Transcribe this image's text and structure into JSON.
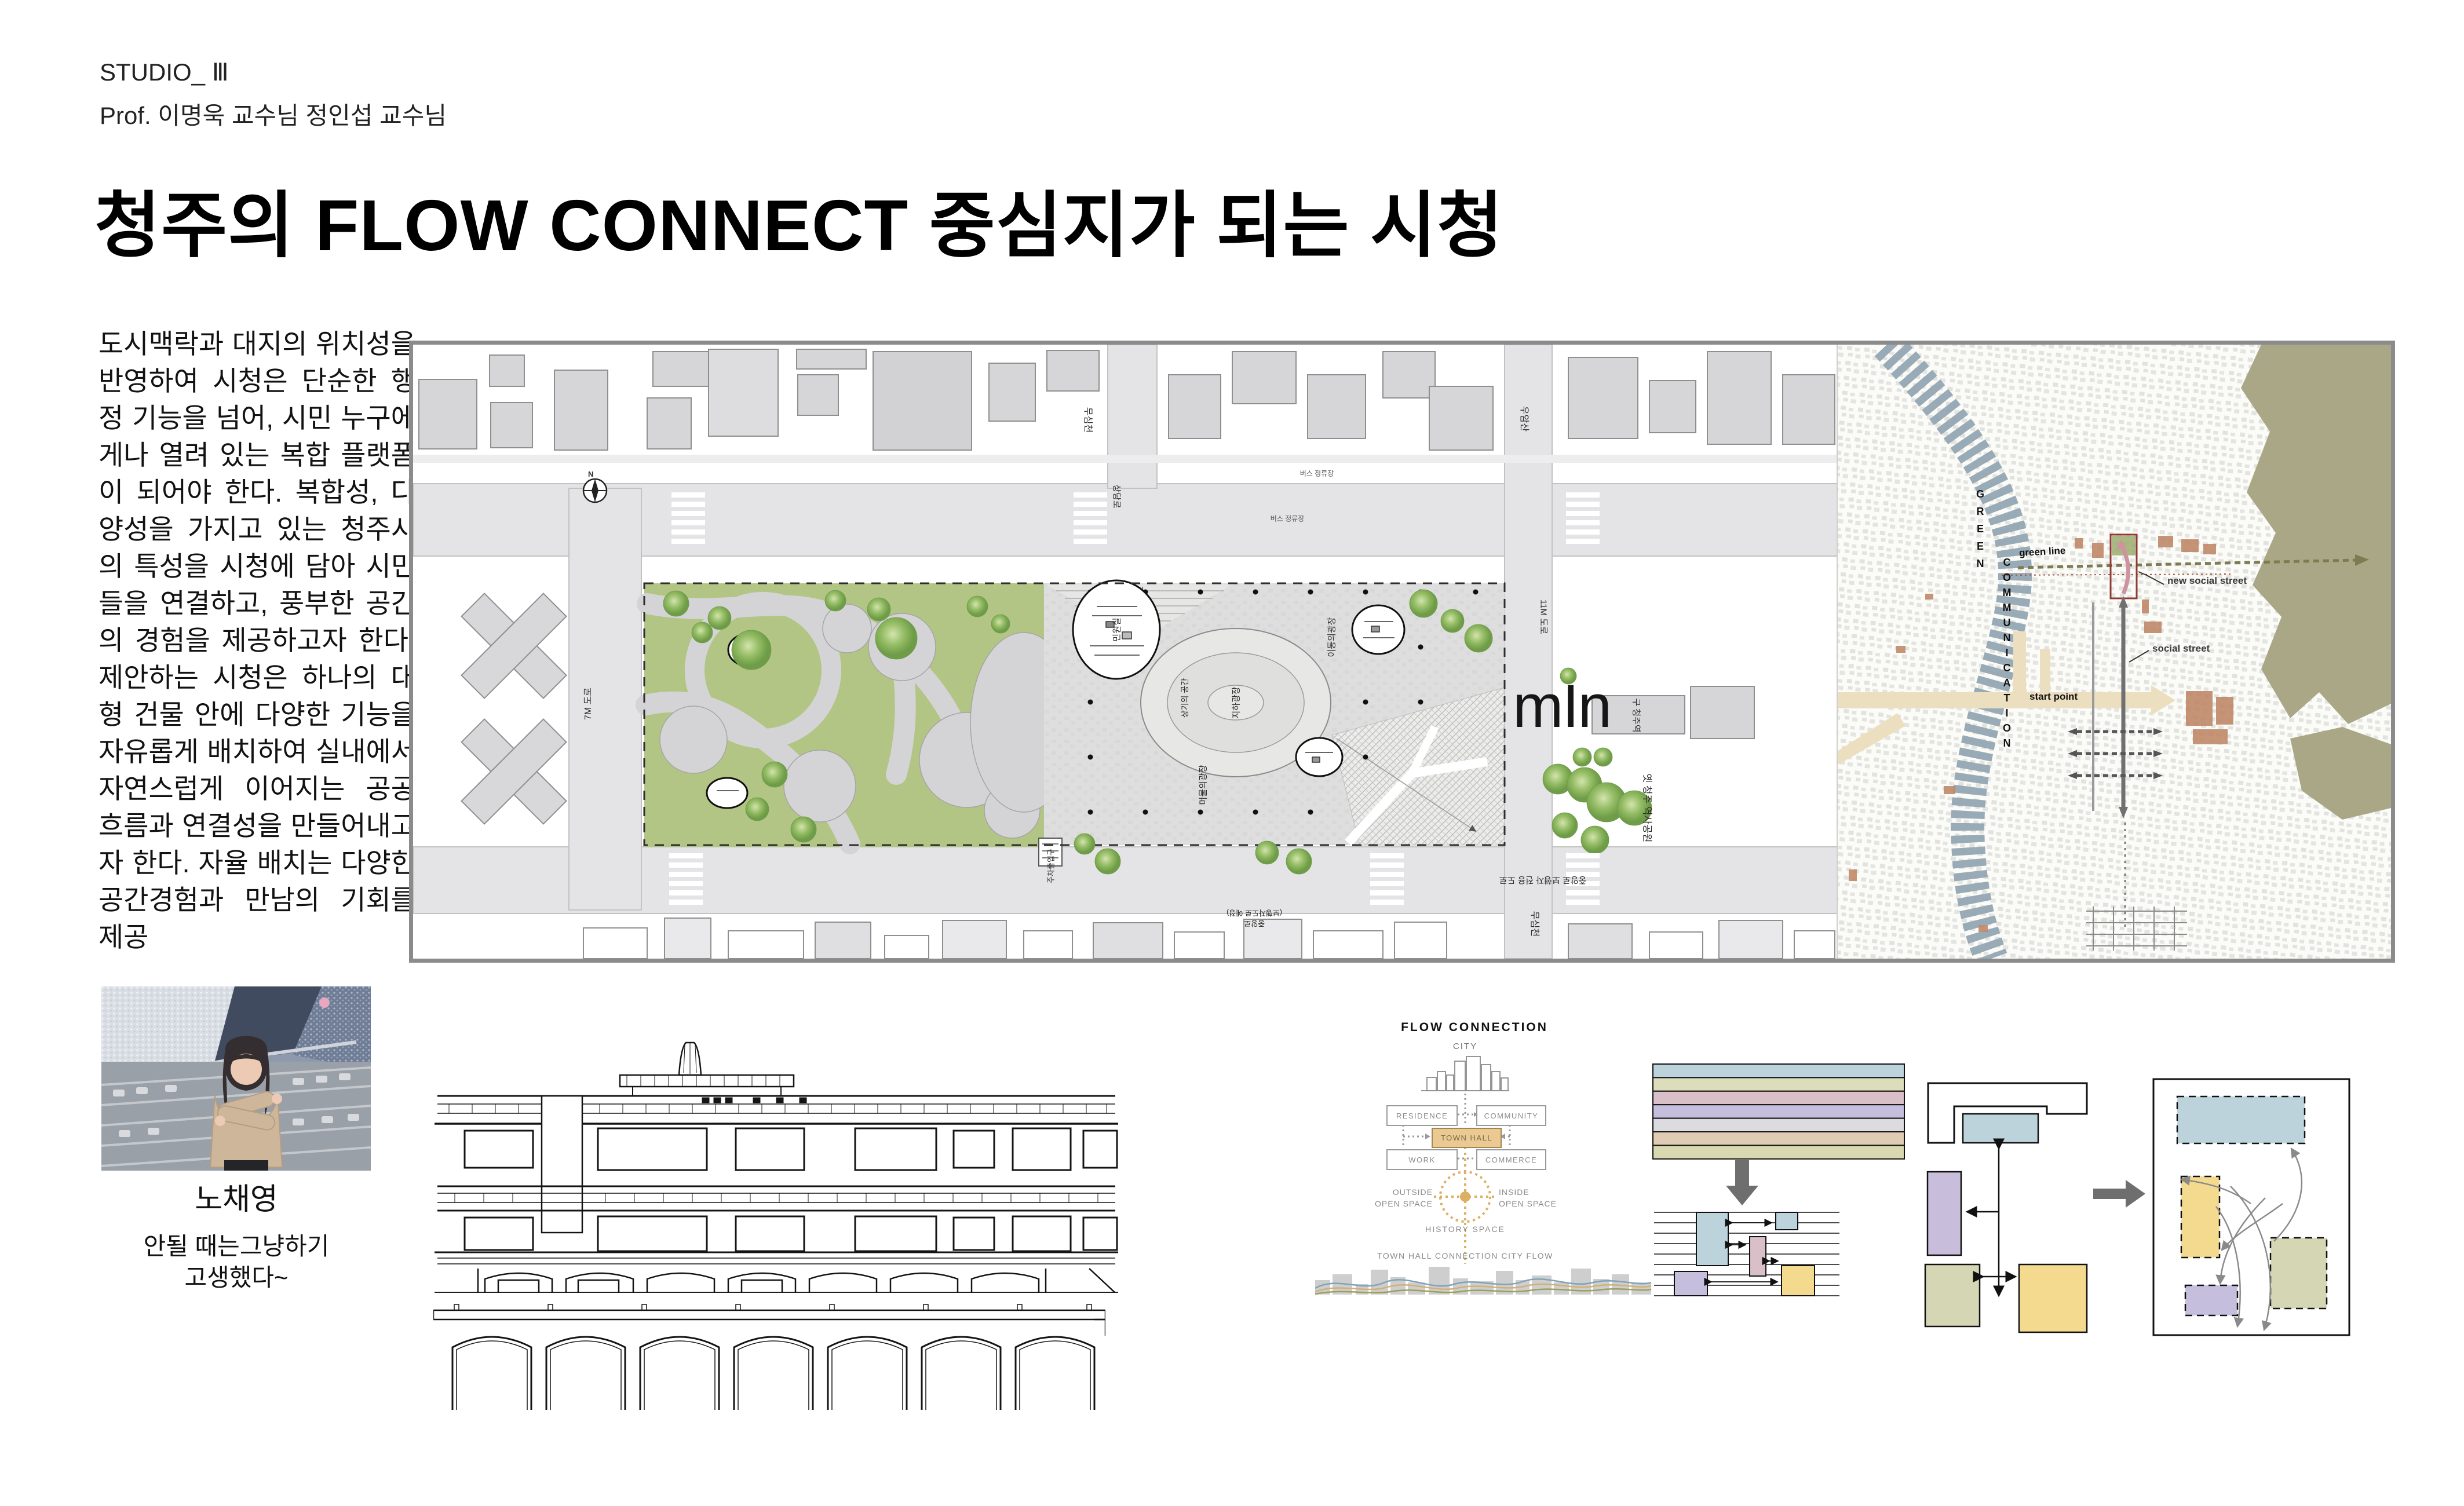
{
  "header": {
    "studio": "STUDIO_ Ⅲ",
    "professors": "Prof. 이명욱 교수님 정인섭 교수님"
  },
  "title": "청주의 FLOW CONNECT 중심지가 되는 시청",
  "intro": "도시맥락과  대지의 위치성을 반영하여 시청은 단순한 행정 기능을 넘어, 시민 누구에게나 열려  있는 복합 플랫폼이 되어야 한다. 복합성, 다양성을 가지고 있는 청주시의 특성을 시청에 담아 시민들을 연결하고, 풍부한 공간의 경험을 제공하고자 한다. 제안하는 시청은 하나의 대형 건물 안에 다양한 기능을 자유롭게 배치하여 실내에서 자연스럽게 이어지는 공공 흐름과 연결성을 만들어내고자 한다. 자율 배치는 다양한 공간경험과 만남의 기회를 제공",
  "member": {
    "name": "노채영",
    "quote_line1": "안될 때는그냥하기",
    "quote_line2": "고생했다~"
  },
  "site_plan": {
    "north": "N",
    "watermark": "mIn",
    "labels": {
      "road_7m": "7M 도로",
      "stream_top": "무심천",
      "sangdang_ro": "상당로",
      "bus_stop_1": "버스 정류장",
      "bus_stop_2": "버스 정류장",
      "wooamsan": "우암산",
      "road_11m": "11M 도로",
      "stream_right": "무심천",
      "old_cheongju_station": "구 청주역",
      "history_park": "옛 청주 역사공원",
      "jungang_ped_road": "중앙로 보행자 전용 도로",
      "jungang_planned": "중앙로\n(보행자도로 예정)",
      "parking_entrance": "주차출입구",
      "sanggi_space": "상기의 공간",
      "minwon_room": "민원실",
      "moving_plaza": "이동의광장",
      "underground_plaza": "지하광장",
      "staying_plaza": "머물의광장"
    }
  },
  "city_map": {
    "labels": {
      "green_word": "GREEN",
      "communication_word": "COMMUNICATION",
      "green_line": "green line",
      "new_social_street": "new social street",
      "social_street": "social street",
      "start_point": "start point"
    }
  },
  "flow_diagram": {
    "title": "FLOW CONNECTION",
    "city": "CITY",
    "residence": "RESIDENCE",
    "community": "COMMUNITY",
    "town_hall": "TOWN HALL",
    "work": "WORK",
    "commerce": "COMMERCE",
    "outside_open_space": "OUTSIDE\nOPEN SPACE",
    "inside_open_space": "INSIDE\nOPEN SPACE",
    "history_space": "HISTORY SPACE",
    "caption": "TOWN HALL CONNECTION CITY FLOW"
  },
  "colors": {
    "accent_tan": "#e9c992",
    "bar_blue": "#bcd3dc",
    "bar_olive": "#dcddba",
    "bar_pink": "#d8bfc8",
    "bar_purple": "#c6bedd",
    "bar_gray": "#dcdce0",
    "bar_tan": "#e0ccb2",
    "bar_yellow": "#f4da8e",
    "map_river": "#92a6b3",
    "map_mountain": "#a9a786",
    "park_green": "#b2c584"
  }
}
